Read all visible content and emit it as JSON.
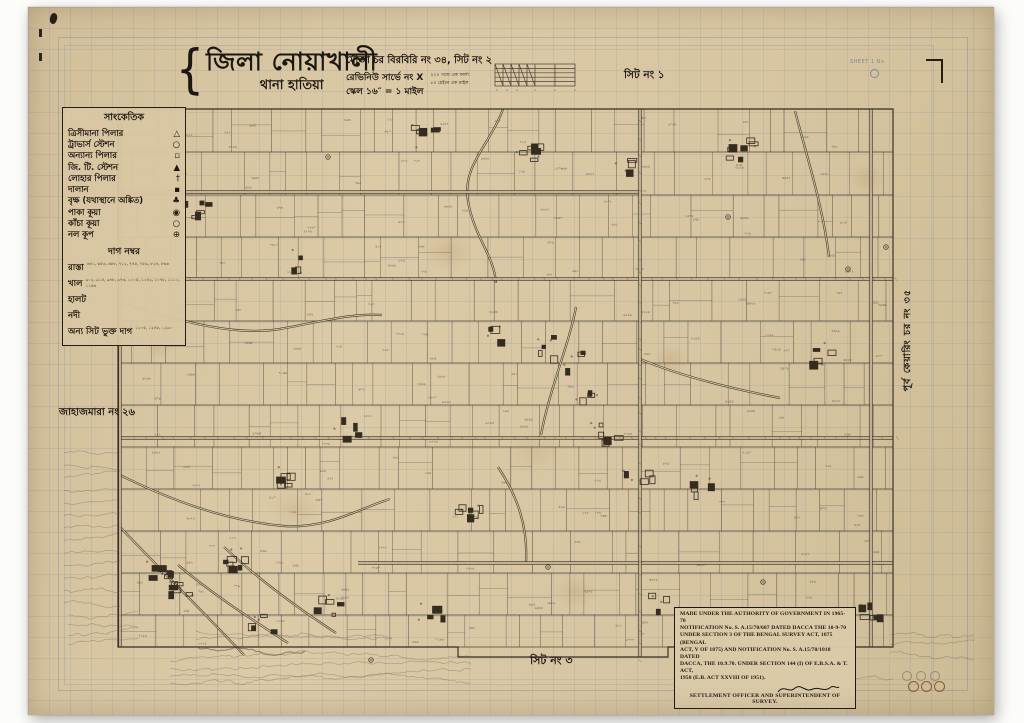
{
  "title_block": {
    "bracket": "{",
    "district": "জিলা নোয়াখালী",
    "thana": "থানা হাতিয়া"
  },
  "info_block": {
    "mouza": "মৌজা চর বিরবিরি নং ৩৪, সিট নং ২",
    "survey": "রেভিনিউ সার্ভে নং X",
    "scale": "স্কেল ১৬″ = ১ মাইল",
    "note1": "২২০ গজে এক ফার্লং",
    "note2": "৮০ চেইনে এক মাইল"
  },
  "adjacent_labels": {
    "top": "সিট নং ১",
    "bottom": "সিট নং ৩",
    "left": "জাহাজমারা নং ২৬",
    "right": "পূর্ব কেয়ারিং চর নং ৩৫"
  },
  "margin_marks": {
    "blue_note": "SHEET 1 No"
  },
  "legend": {
    "heading": "সাংকেতিক",
    "symbols": [
      {
        "label": "ত্রিসীমানা পিলার",
        "glyph": "△"
      },
      {
        "label": "ট্রাভার্স স্টেশন",
        "glyph": "○"
      },
      {
        "label": "অন্যান্য পিলার",
        "glyph": "▫"
      },
      {
        "label": "জি. টি. স্টেশন",
        "glyph": "▲"
      },
      {
        "label": "লোহার পিলার",
        "glyph": "†"
      },
      {
        "label": "দালান",
        "glyph": "▪"
      },
      {
        "label": "বৃক্ষ (যথাস্থানে অঙ্কিত)",
        "glyph": "♣"
      },
      {
        "label": "পাকা কূয়া",
        "glyph": "◉"
      },
      {
        "label": "কাঁচা কূয়া",
        "glyph": "○"
      },
      {
        "label": "নল কূপ",
        "glyph": "⊕"
      }
    ],
    "dag_heading": "দাগ নম্বর",
    "line_items": [
      {
        "label": "রাস্তা",
        "numbers": "৬৪১, ৬৫৩, ৬৮৮, ৭১২, ৭৪৫, ৭৮৯, ৮২৪, ৮৬৬"
      },
      {
        "label": "খাল",
        "numbers": "৯০২, ৯১৫, ৯৪৮, ৯৭৩, ১০০৫, ১০৪২, ১০৭৮, ১১১০, ১১৫৬"
      },
      {
        "label": "হালট",
        "numbers": ""
      },
      {
        "label": "নদী",
        "numbers": ""
      },
      {
        "label": "অন্য সিট ভুক্ত দাগ",
        "numbers": "১২০৫, ১২৪৮, ১২৯০"
      }
    ]
  },
  "notification": {
    "lines": [
      "MADE UNDER THE AUTHORITY OF GOVERNMENT IN 1965-70",
      "NOTIFICATION No. S. A.15/70/687 DATED DACCA THE 10-9-70",
      "UNDER SECTION 3 OF THE BENGAL SURVEY ACT, 1875 (BENGAL",
      "ACT, V OF 1875) AND NOTIFICATION No. S. A.15/70/1018 DATED",
      "DACCA, THE 10.9.70. UNDER SECTION 144 (I) OF E.B.S.A. & T. ACT,",
      "1950 (E.B. ACT XXVIII OF 1951)."
    ],
    "footer": "SETTLEMENT OFFICER AND SUPERINTENDENT OF SURVEY."
  },
  "map": {
    "seed": 20240817,
    "ink": "#352c20",
    "paper": "#d8c6a2",
    "bounds": {
      "x1": 90,
      "y1": 102,
      "x2": 865,
      "y2": 640
    },
    "strip_ys": [
      102,
      145,
      188,
      230,
      272,
      314,
      356,
      398,
      440,
      482,
      524,
      566,
      608,
      640
    ],
    "border_path": "M90,102 L865,102 L865,640 L640,640 L640,650 L430,650 L430,640 L90,640 Z",
    "roads_h": [
      {
        "y": 185,
        "x1": 90,
        "x2": 612,
        "ticks": false
      },
      {
        "y": 272,
        "x1": 90,
        "x2": 865,
        "ticks": true
      },
      {
        "y": 431,
        "x1": 90,
        "x2": 865,
        "ticks": true
      },
      {
        "y": 556,
        "x1": 330,
        "x2": 865,
        "ticks": false
      }
    ],
    "roads_v": [
      {
        "x": 92,
        "y1": 102,
        "y2": 640,
        "ticks": false
      },
      {
        "x": 612,
        "y1": 102,
        "y2": 650,
        "ticks": true
      },
      {
        "x": 843,
        "y1": 102,
        "y2": 640,
        "ticks": false
      }
    ],
    "canals": [
      "M475,102 C462,138 434,158 440,194 C446,230 466,248 468,276",
      "M92,296 C148,312 202,330 252,322 C292,315 322,306 354,308",
      "M92,468 C140,492 198,514 256,519 C300,522 332,501 362,492",
      "M548,300 C541,338 522,380 513,428",
      "M612,352 C650,368 700,381 752,391",
      "M767,104 C779,150 795,200 801,250",
      "M196,540 C228,570 268,600 308,626",
      "M150,558 C188,590 228,615 260,636",
      "M92,520 C128,558 178,608 216,648",
      "M470,460 C490,490 500,520 498,556"
    ],
    "clusters": [
      [
        392,
        129
      ],
      [
        502,
        146
      ],
      [
        602,
        160
      ],
      [
        712,
        140
      ],
      [
        167,
        200
      ],
      [
        272,
        255
      ],
      [
        467,
        330
      ],
      [
        523,
        338
      ],
      [
        549,
        352
      ],
      [
        562,
        394
      ],
      [
        578,
        424
      ],
      [
        610,
        462
      ],
      [
        202,
        549
      ],
      [
        154,
        585
      ],
      [
        233,
        614
      ],
      [
        402,
        604
      ],
      [
        622,
        592
      ],
      [
        672,
        474
      ],
      [
        790,
        346
      ],
      [
        440,
        498
      ],
      [
        320,
        420
      ],
      [
        258,
        470
      ],
      [
        130,
        560
      ],
      [
        300,
        600
      ],
      [
        840,
        600
      ]
    ],
    "wells": [
      [
        300,
        150
      ],
      [
        700,
        210
      ],
      [
        820,
        262
      ],
      [
        520,
        560
      ],
      [
        343,
        653
      ],
      [
        858,
        240
      ],
      [
        735,
        575
      ]
    ],
    "numbers_per_strip": 13,
    "scribble_boxes": [
      {
        "x": 36,
        "y": 446,
        "w": 62,
        "n": 13,
        "step": 12.5
      },
      {
        "x": 40,
        "y": 608,
        "w": 70,
        "n": 4,
        "step": 10
      },
      {
        "x": 142,
        "y": 654,
        "w": 306,
        "n": 4,
        "step": 7.5
      },
      {
        "x": 168,
        "y": 624,
        "w": 200,
        "n": 2,
        "step": 8
      },
      {
        "x": 165,
        "y": 640,
        "w": 115,
        "n": 1,
        "step": 8,
        "bold": true
      },
      {
        "x": 746,
        "y": 672,
        "w": 120,
        "n": 1,
        "step": 8
      },
      {
        "x": 862,
        "y": 628,
        "w": 90,
        "n": 3,
        "step": 9
      }
    ]
  }
}
